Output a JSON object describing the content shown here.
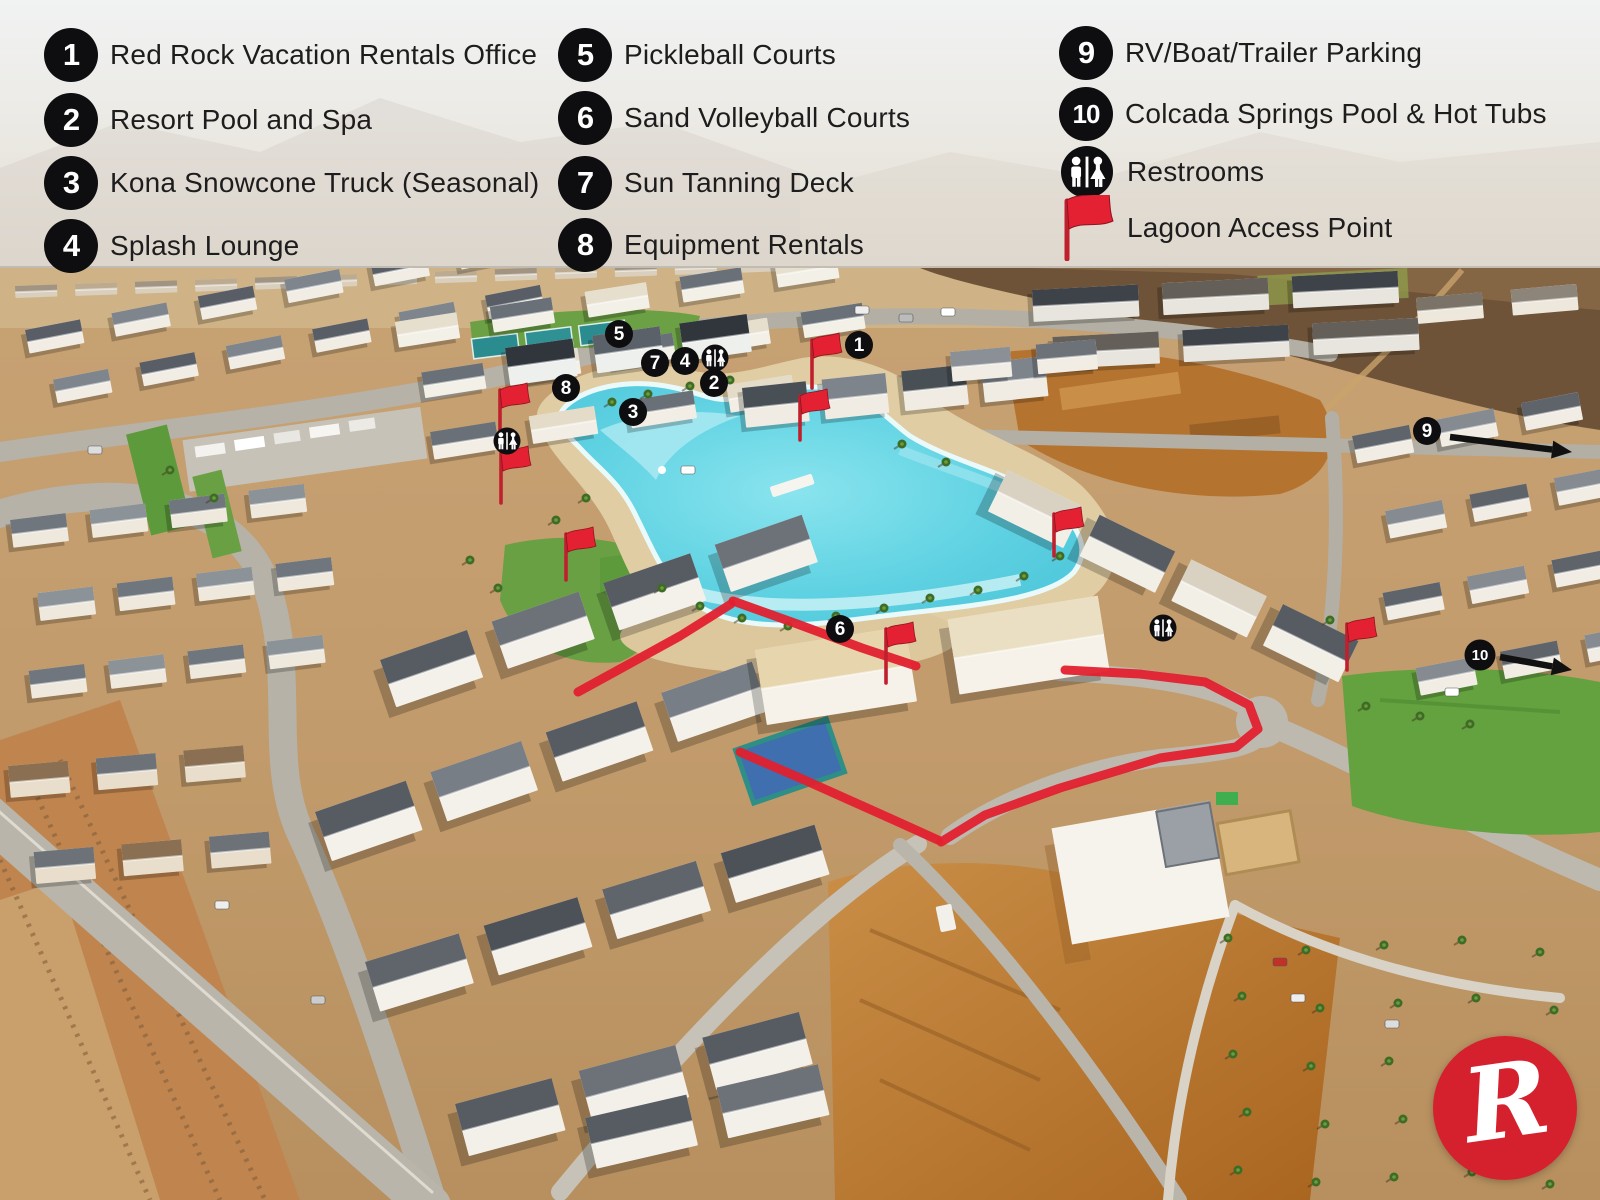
{
  "legend": {
    "items": [
      {
        "num": "1",
        "label": "Red Rock Vacation Rentals Office"
      },
      {
        "num": "2",
        "label": "Resort Pool and Spa"
      },
      {
        "num": "3",
        "label": "Kona Snowcone Truck (Seasonal)"
      },
      {
        "num": "4",
        "label": "Splash Lounge"
      },
      {
        "num": "5",
        "label": "Pickleball Courts"
      },
      {
        "num": "6",
        "label": "Sand Volleyball Courts"
      },
      {
        "num": "7",
        "label": "Sun Tanning Deck"
      },
      {
        "num": "8",
        "label": "Equipment Rentals"
      },
      {
        "num": "9",
        "label": "RV/Boat/Trailer Parking"
      },
      {
        "num": "10",
        "label": "Colcada Springs Pool & Hot Tubs"
      },
      {
        "num": "",
        "icon": "restrooms-icon",
        "label": "Restrooms"
      },
      {
        "num": "",
        "icon": "flag-icon",
        "label": "Lagoon Access Point"
      }
    ]
  },
  "map": {
    "markers": [
      {
        "num": "1",
        "x": 859,
        "y": 345
      },
      {
        "num": "2",
        "x": 714,
        "y": 383
      },
      {
        "num": "3",
        "x": 633,
        "y": 412
      },
      {
        "num": "4",
        "x": 685,
        "y": 361
      },
      {
        "num": "5",
        "x": 619,
        "y": 334
      },
      {
        "num": "6",
        "x": 840,
        "y": 629
      },
      {
        "num": "7",
        "x": 655,
        "y": 363
      },
      {
        "num": "8",
        "x": 566,
        "y": 388
      },
      {
        "num": "9",
        "x": 1427,
        "y": 431
      },
      {
        "num": "10",
        "x": 1480,
        "y": 655
      }
    ],
    "restroom_markers": [
      {
        "x": 715,
        "y": 358
      },
      {
        "x": 507,
        "y": 441
      },
      {
        "x": 1163,
        "y": 628
      }
    ],
    "access_flags": [
      {
        "x": 500,
        "y": 390,
        "h": 50
      },
      {
        "x": 501,
        "y": 453,
        "h": 50
      },
      {
        "x": 566,
        "y": 534,
        "h": 46
      },
      {
        "x": 812,
        "y": 340,
        "h": 48
      },
      {
        "x": 800,
        "y": 396,
        "h": 44
      },
      {
        "x": 1054,
        "y": 514,
        "h": 42
      },
      {
        "x": 886,
        "y": 629,
        "h": 54
      },
      {
        "x": 1347,
        "y": 624,
        "h": 46
      }
    ],
    "arrows": [
      {
        "x1": 1450,
        "y1": 437,
        "x2": 1572,
        "y2": 452
      },
      {
        "x1": 1500,
        "y1": 657,
        "x2": 1572,
        "y2": 670
      }
    ],
    "route": [
      [
        [
          578,
          692
        ],
        [
          620,
          669
        ],
        [
          680,
          636
        ],
        [
          731,
          604
        ]
      ],
      [
        [
          733,
          601
        ],
        [
          800,
          625
        ],
        [
          862,
          648
        ],
        [
          916,
          666
        ]
      ],
      [
        [
          1065,
          670
        ],
        [
          1140,
          674
        ],
        [
          1205,
          682
        ],
        [
          1249,
          705
        ],
        [
          1258,
          729
        ],
        [
          1236,
          747
        ],
        [
          1160,
          758
        ],
        [
          1060,
          788
        ],
        [
          985,
          815
        ],
        [
          941,
          842
        ]
      ],
      [
        [
          740,
          752
        ],
        [
          800,
          778
        ],
        [
          876,
          812
        ],
        [
          938,
          840
        ]
      ]
    ],
    "colors": {
      "accent": "#E2202F",
      "marker_bg": "#0E0E10",
      "marker_fg": "#FFFFFF",
      "water": "#5FD2E2"
    }
  },
  "logo": {
    "letter": "R",
    "color": "#D5202E"
  }
}
